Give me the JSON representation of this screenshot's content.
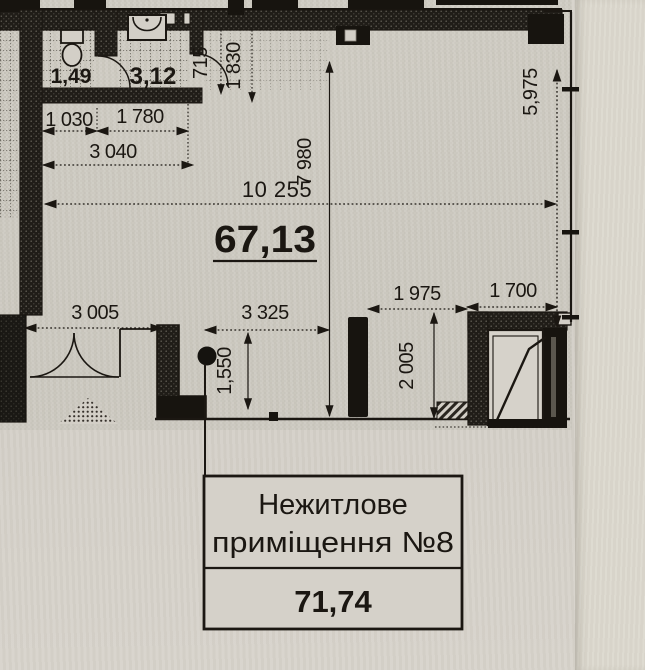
{
  "plan": {
    "rooms": {
      "wc_area": "1,49",
      "bath_area": "3,12",
      "main_area": "67,13"
    },
    "dims": {
      "d715": "715",
      "d1830": "1 830",
      "d1030": "1 030",
      "d1780": "1 780",
      "d3040": "3 040",
      "d10255": "10 255",
      "d7980": "7 980",
      "d5975": "5,975",
      "d3005": "3 005",
      "d3325": "3 325",
      "d1550": "1,550",
      "d1975": "1 975",
      "d1700": "1 700",
      "d2005": "2 005"
    },
    "label_box": {
      "line1": "Нежитлове",
      "line2": "приміщення №8",
      "area": "71,74"
    },
    "colors": {
      "paper": "#d3cfc7",
      "paper_margin": "#dcd8ce",
      "ink": "#1b1712"
    }
  }
}
